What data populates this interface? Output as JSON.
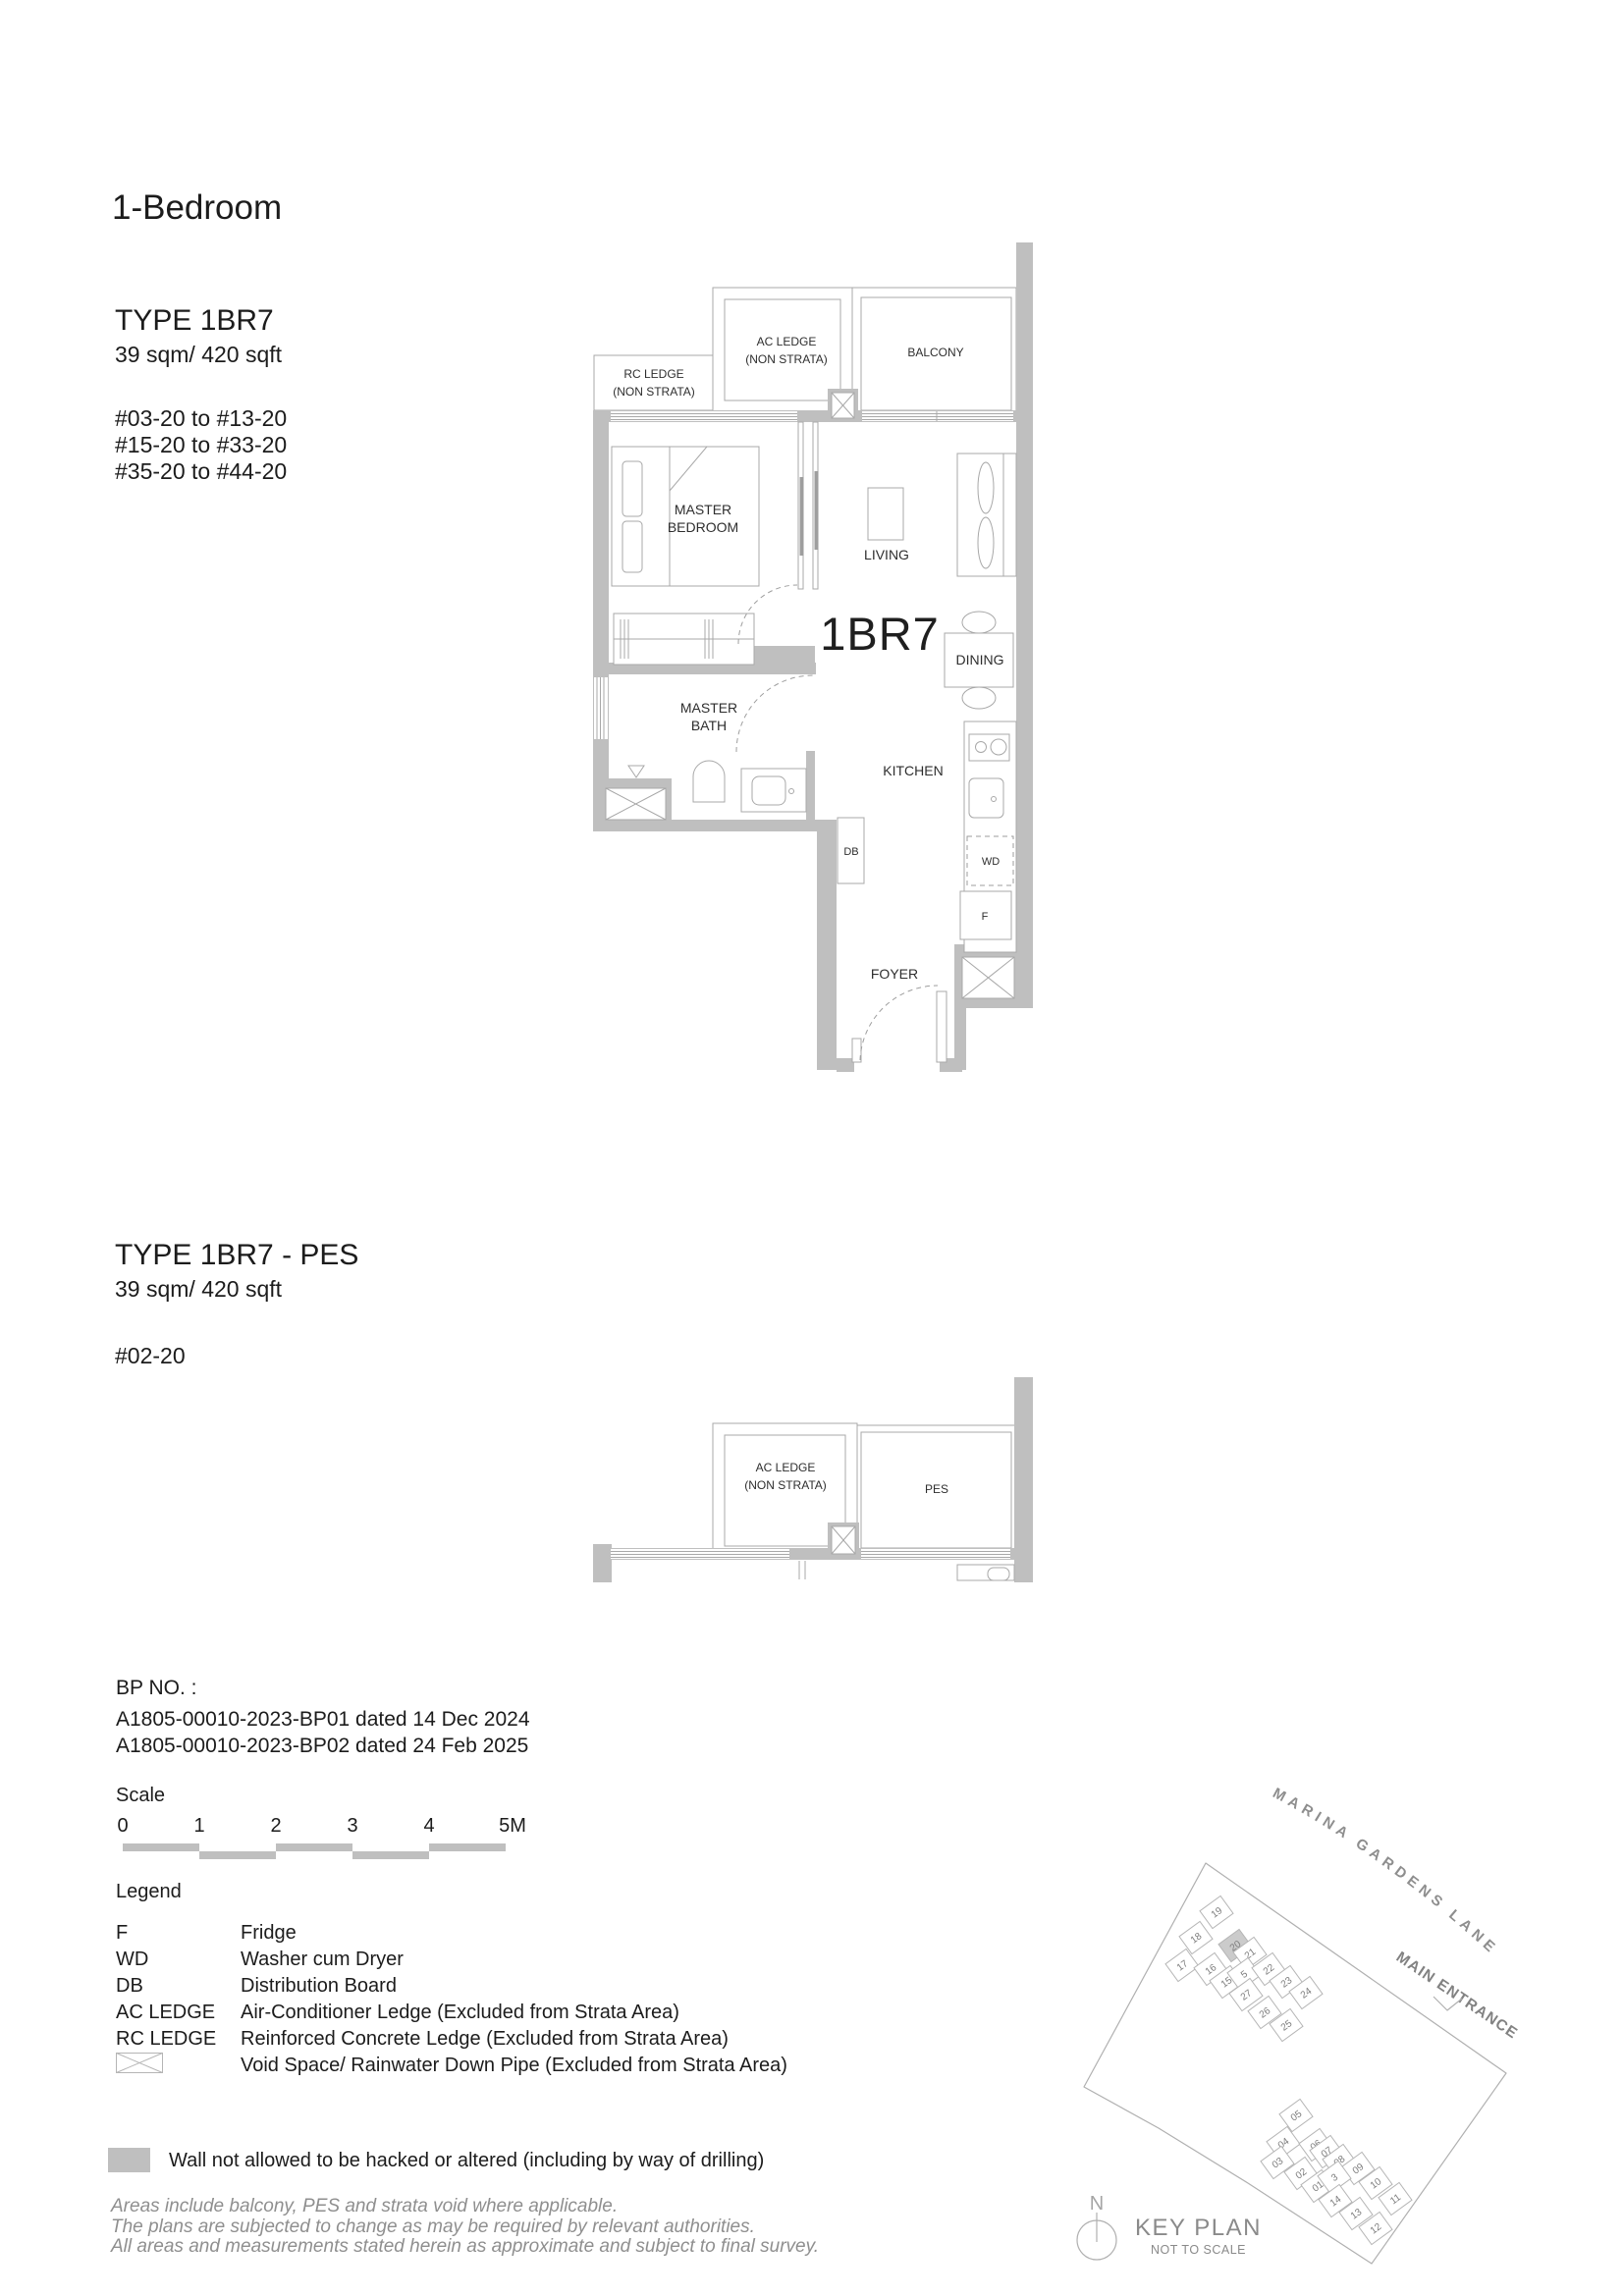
{
  "page": {
    "title": "1-Bedroom"
  },
  "plan1": {
    "type": "TYPE 1BR7",
    "area": "39 sqm/ 420 sqft",
    "units": [
      "#03-20 to #13-20",
      "#15-20 to #33-20",
      "#35-20 to #44-20"
    ],
    "labels": {
      "rc_ledge_1": "RC LEDGE",
      "rc_ledge_2": "(NON STRATA)",
      "ac_ledge_1": "AC LEDGE",
      "ac_ledge_2": "(NON STRATA)",
      "balcony": "BALCONY",
      "master_bedroom_1": "MASTER",
      "master_bedroom_2": "BEDROOM",
      "living": "LIVING",
      "unit_code": "1BR7",
      "dining": "DINING",
      "master_bath_1": "MASTER",
      "master_bath_2": "BATH",
      "kitchen": "KITCHEN",
      "db": "DB",
      "wd": "WD",
      "fridge": "F",
      "foyer": "FOYER"
    }
  },
  "plan2": {
    "type": "TYPE 1BR7 - PES",
    "area": "39 sqm/ 420 sqft",
    "units": [
      "#02-20"
    ],
    "labels": {
      "ac_ledge_1": "AC LEDGE",
      "ac_ledge_2": "(NON STRATA)",
      "pes": "PES"
    }
  },
  "bp": {
    "title": "BP NO. :",
    "lines": [
      "A1805-00010-2023-BP01 dated 14 Dec 2024",
      "A1805-00010-2023-BP02 dated 24 Feb 2025"
    ]
  },
  "scale": {
    "label": "Scale",
    "ticks": [
      "0",
      "1",
      "2",
      "3",
      "4",
      "5M"
    ]
  },
  "legend": {
    "title": "Legend",
    "items": [
      {
        "term": "F",
        "desc": "Fridge"
      },
      {
        "term": "WD",
        "desc": "Washer cum Dryer"
      },
      {
        "term": "DB",
        "desc": "Distribution Board"
      },
      {
        "term": "AC LEDGE",
        "desc": "Air-Conditioner Ledge (Excluded from Strata Area)"
      },
      {
        "term": "RC LEDGE",
        "desc": "Reinforced Concrete Ledge (Excluded from Strata Area)"
      }
    ],
    "void_symbol": "void-space-icon",
    "void_desc": "Void Space/ Rainwater Down Pipe (Excluded from Strata Area)"
  },
  "wall_note": "Wall not allowed to be hacked or altered (including by way of drilling)",
  "disclaimer": [
    "Areas include balcony, PES and strata void where applicable.",
    "The plans are subjected to change as may be required by relevant authorities.",
    "All areas and measurements stated herein as approximate and subject to final survey."
  ],
  "keyplan": {
    "street": "MARINA GARDENS LANE",
    "entrance": "MAIN ENTRANCE",
    "title": "KEY PLAN",
    "subtitle": "NOT TO SCALE",
    "north": "N",
    "highlighted_unit": "20",
    "units": [
      "19",
      "18",
      "17",
      "16",
      "15",
      "20",
      "21",
      "5",
      "22",
      "23",
      "24",
      "27",
      "26",
      "25",
      "05",
      "04",
      "03",
      "06",
      "07",
      "08",
      "09",
      "02",
      "01",
      "3",
      "10",
      "11",
      "14",
      "13",
      "12"
    ]
  },
  "colors": {
    "wall": "#bfbfbf",
    "line": "#a8a8a8",
    "text": "#1c1c1c",
    "muted": "#8e8e8e",
    "highlight": "#cbcbcb"
  }
}
